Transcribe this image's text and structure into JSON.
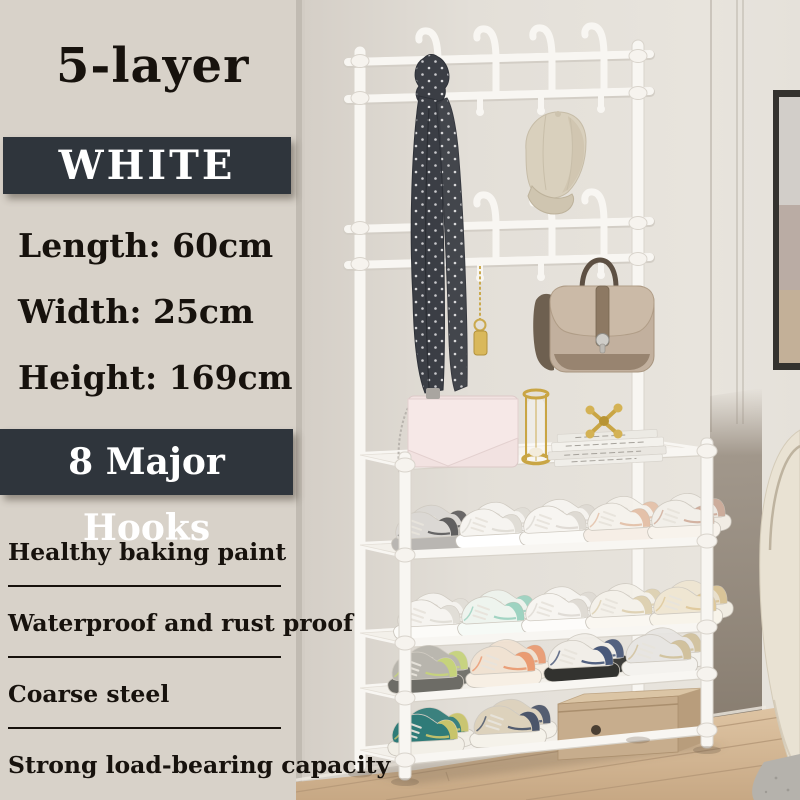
{
  "product": {
    "title": "5-layer",
    "color_badge": "WHITE",
    "dimensions": [
      "Length: 60cm",
      "Width: 25cm",
      "Height: 169cm"
    ],
    "hooks_badge": "8 Major Hooks",
    "features": [
      "Healthy baking paint",
      "Waterproof and rust proof",
      "Coarse steel",
      "Strong load-bearing capacity"
    ]
  },
  "colors": {
    "panel_bg": "#d8d2c9",
    "badge_bg": "#2f353c",
    "badge_text": "#ffffff",
    "text": "#17120d",
    "rack_white": "#f8f6f2",
    "wall": "#e2ded7",
    "wall_dark_band": "#877b6e",
    "floor_wood": "#d3b896",
    "armchair": "#e9e2d3",
    "scarf": "#3b3e45",
    "cap": "#d9d0bd",
    "satchel": "#c2b09e",
    "clutch": "#f2e2e1",
    "gold": "#c9a544",
    "shoe_box": "#c7ad8d"
  },
  "photo": {
    "items": [
      "coat-rack",
      "hook-rows",
      "scarf",
      "baseball-cap",
      "leather-satchel",
      "gold-keychain",
      "pink-clutch",
      "gold-hourglass",
      "book-stack",
      "gold-jack-ornament",
      "sneaker-rows",
      "cardboard-shoe-box",
      "picture-frame",
      "wall-trim",
      "armchair",
      "rug",
      "wood-floor"
    ],
    "shoe_rows": [
      {
        "shelf": 2,
        "y": 553,
        "tilt": -0.046,
        "x0": 92,
        "gap": 64,
        "scale": 1.0,
        "shoes": [
          {
            "u": "#dbd8d4",
            "a": "#4a4a4a",
            "s": "#b9b6b2"
          },
          {
            "u": "#f6f4f0",
            "a": "#dcd8d1",
            "s": "#ffffff"
          },
          {
            "u": "#f7f5f1",
            "a": "#d9d5ce",
            "s": "#fbfaf7"
          },
          {
            "u": "#f5f2ec",
            "a": "#e0b89d",
            "s": "#f6eee6"
          },
          {
            "u": "#f2efe9",
            "a": "#caa28f",
            "s": "#f8f3ec"
          }
        ]
      },
      {
        "shelf": 3,
        "y": 641,
        "tilt": -0.05,
        "x0": 94,
        "gap": 64,
        "scale": 1.0,
        "shoes": [
          {
            "u": "#f6f4f0",
            "a": "#ddd9d2",
            "s": "#fcfbf8"
          },
          {
            "u": "#eef4ee",
            "a": "#8fccb8",
            "s": "#f6faf6"
          },
          {
            "u": "#f7f5f1",
            "a": "#dad6cf",
            "s": "#fdfcfa"
          },
          {
            "u": "#f4f1ea",
            "a": "#d9cba8",
            "s": "#faf7f1"
          },
          {
            "u": "#efe6d2",
            "a": "#dcc391",
            "s": "#f8f4ea"
          }
        ]
      },
      {
        "shelf": 4,
        "y": 694,
        "tilt": -0.075,
        "x0": 88,
        "gap": 78,
        "scale": 1.04,
        "shoes": [
          {
            "u": "#b8b5ad",
            "a": "#c8d872",
            "s": "#6d6c66"
          },
          {
            "u": "#f0e2d2",
            "a": "#e98e62",
            "s": "#f7efe4"
          },
          {
            "u": "#f1eee8",
            "a": "#2c3e66",
            "s": "#32322f"
          },
          {
            "u": "#e7e5e2",
            "a": "#cdbb90",
            "s": "#f4f2ee"
          }
        ]
      },
      {
        "shelf": 5,
        "y": 756,
        "tilt": -0.1,
        "x0": 88,
        "gap": 82,
        "scale": 1.05,
        "shoes": [
          {
            "u": "#2f7b78",
            "a": "#e3d168",
            "s": "#f2efe7"
          },
          {
            "u": "#ddd2bc",
            "a": "#31405c",
            "s": "#f5f2ea"
          }
        ]
      }
    ]
  }
}
